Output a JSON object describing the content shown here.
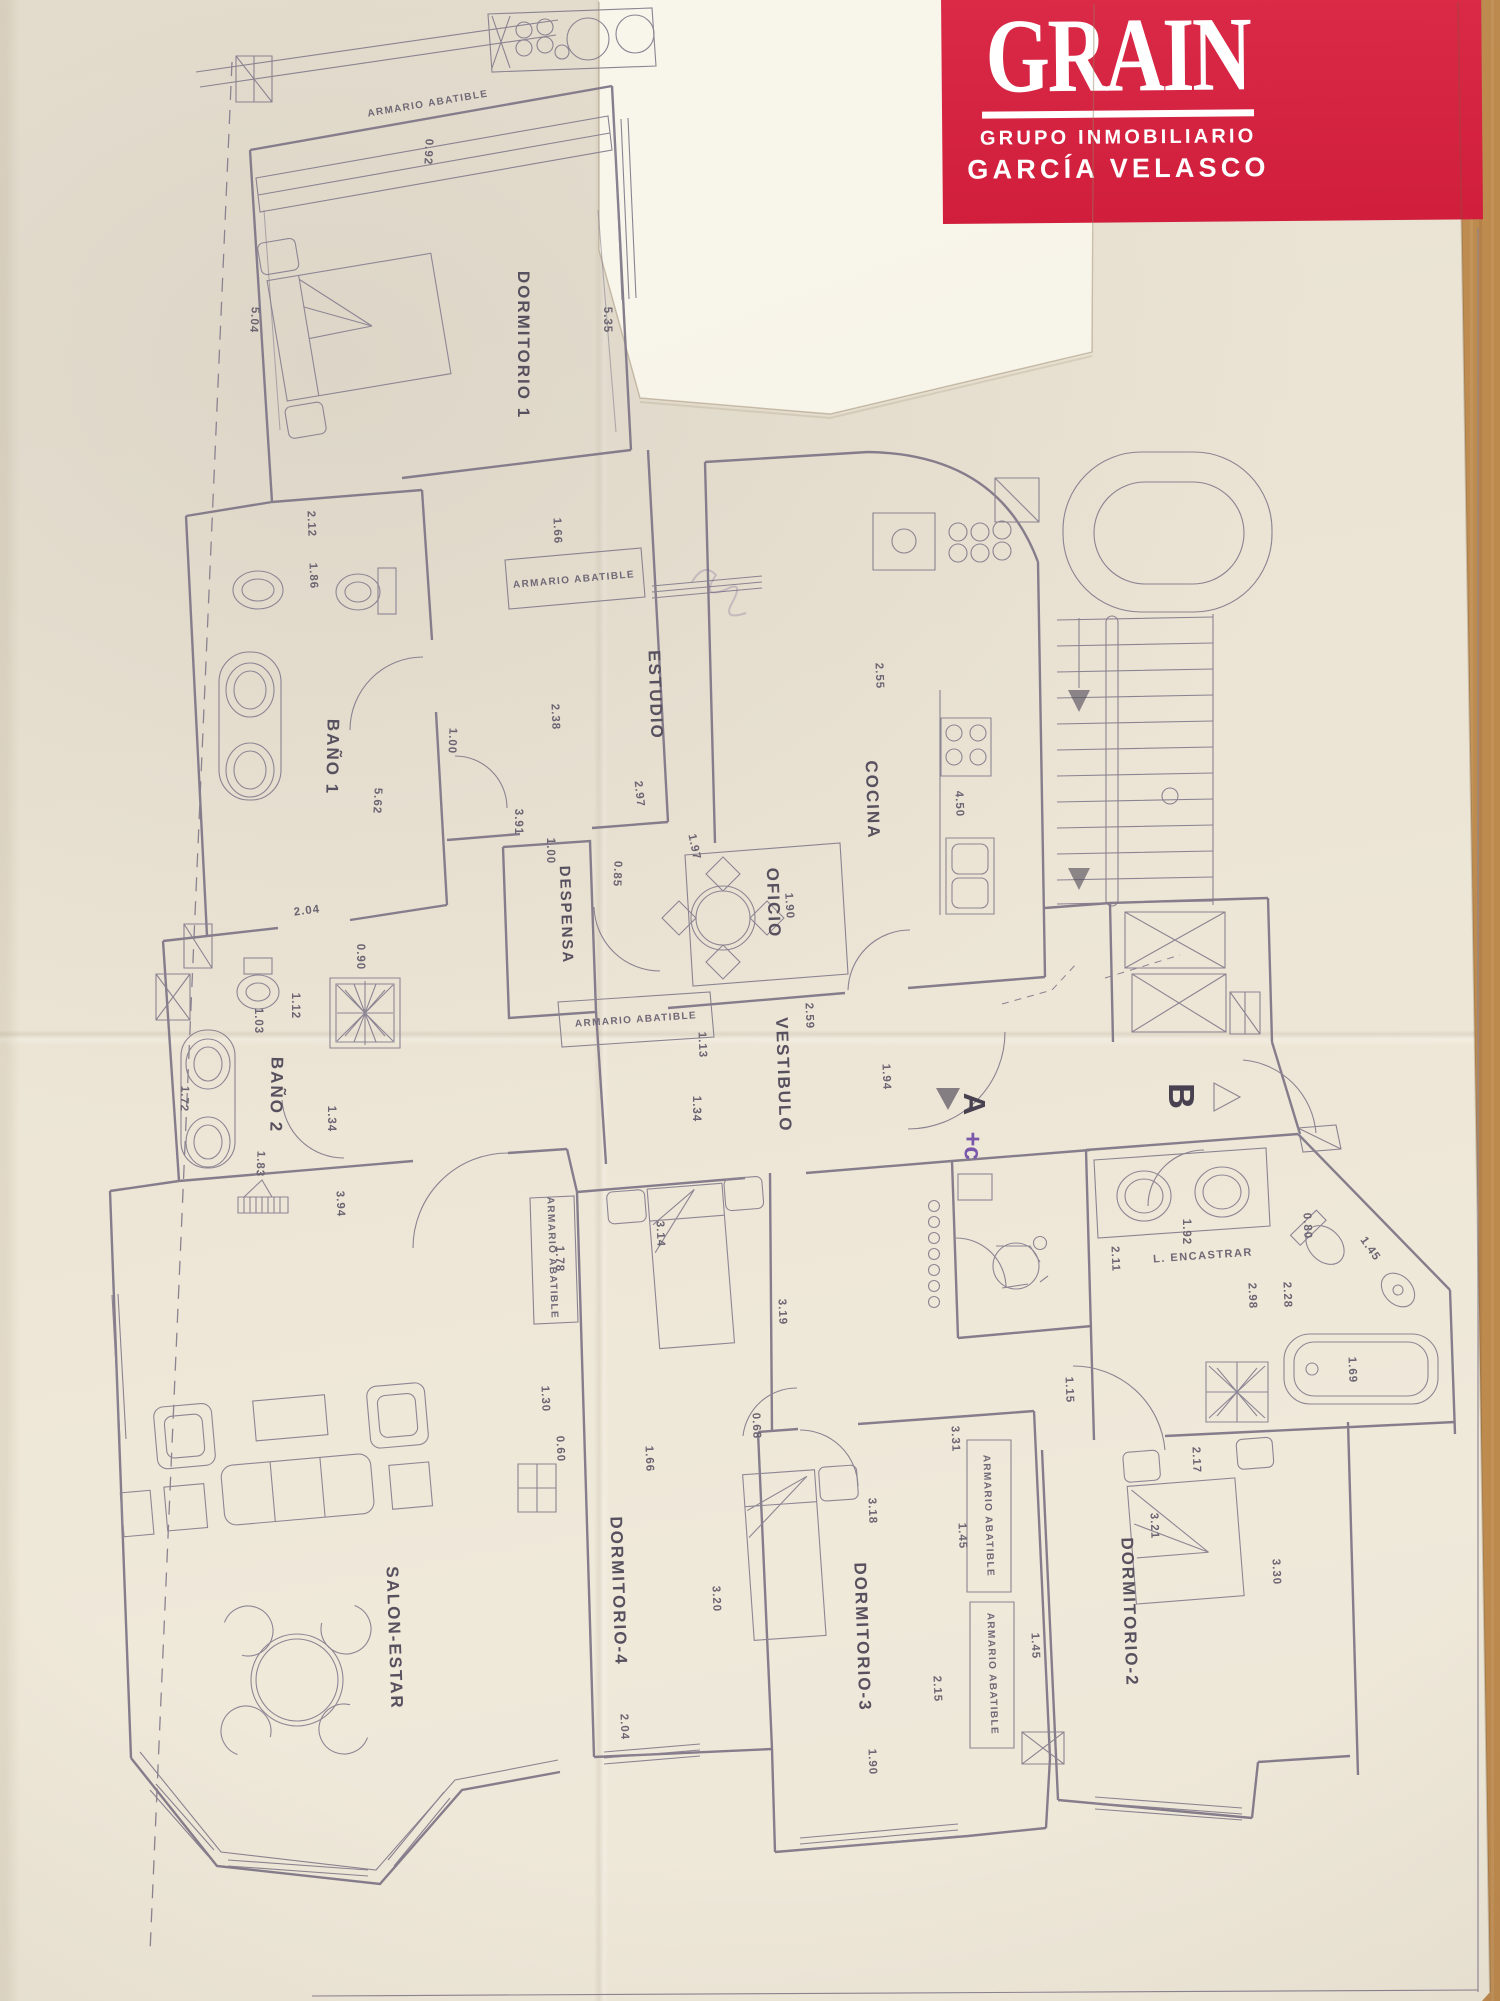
{
  "logo": {
    "brand": "GRAIN",
    "tagline1": "GRUPO INMOBILIARIO",
    "tagline2": "GARCÍA VELASCO",
    "background": "#d01e3c",
    "text_color": "#ffffff"
  },
  "plan": {
    "wardrobe_label": "ARMARIO ABATIBLE",
    "builtin_note": "L. ENCASTRAR",
    "zones": {
      "entrance_a": "A",
      "entrance_a_suffix": "+c",
      "entrance_b": "B"
    },
    "rooms": [
      {
        "label": "DORMITORIO 1"
      },
      {
        "label": "BAÑO 1"
      },
      {
        "label": "BAÑO 2"
      },
      {
        "label": "ESTUDIO"
      },
      {
        "label": "DESPENSA"
      },
      {
        "label": "OFICIO"
      },
      {
        "label": "COCINA"
      },
      {
        "label": "VESTIBULO"
      },
      {
        "label": "SALON-ESTAR"
      },
      {
        "label": "DORMITORIO-4"
      },
      {
        "label": "DORMITORIO-3"
      },
      {
        "label": "DORMITORIO-2"
      }
    ],
    "dimensions": [
      "0.92",
      "5.04",
      "5.35",
      "2.12",
      "1.86",
      "1.66",
      "2.38",
      "2.97",
      "1.97",
      "0.85",
      "1.00",
      "1.00",
      "3.91",
      "5.62",
      "2.04",
      "0.90",
      "1.12",
      "1.03",
      "1.72",
      "1.34",
      "1.83",
      "3.94",
      "2.55",
      "4.50",
      "1.90",
      "2.59",
      "1.94",
      "1.34",
      "1.13",
      "1.78",
      "1.30",
      "0.60",
      "3.14",
      "3.19",
      "1.66",
      "0.68",
      "3.20",
      "2.04",
      "3.18",
      "3.31",
      "1.45",
      "2.15",
      "1.90",
      "1.45",
      "2.11",
      "1.92",
      "2.98",
      "2.28",
      "0.80",
      "1.45",
      "1.69",
      "1.15",
      "2.17",
      "3.21",
      "3.30"
    ]
  },
  "colors": {
    "ink": "#857d8b",
    "label_ink": "#57505e",
    "paper": "#ece5d5",
    "accent_letter": "#7a57ab"
  }
}
